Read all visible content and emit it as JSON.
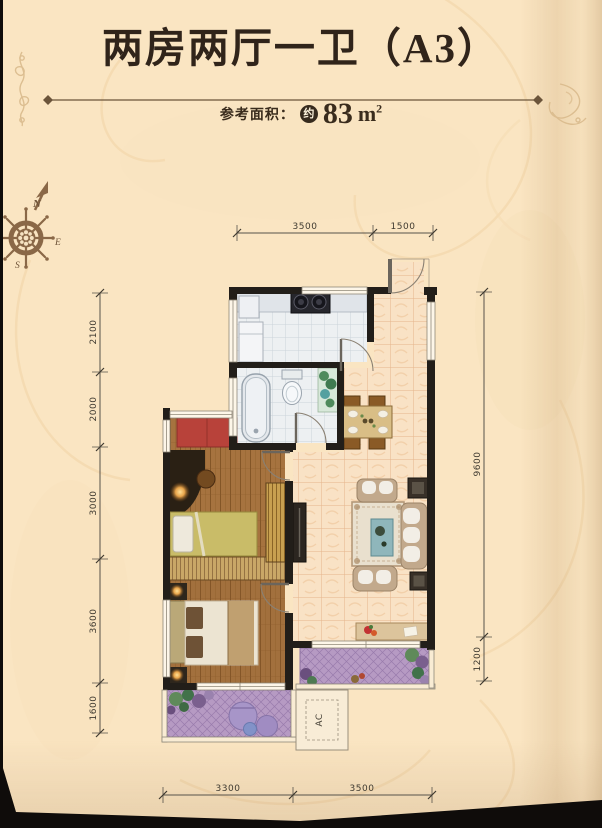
{
  "header": {
    "title": "两房两厅一卫（A3）",
    "area_label": "参考面积：",
    "area_approx_badge": "约",
    "area_value": "83",
    "area_unit": "m",
    "area_exponent": "2"
  },
  "compass": {
    "north": "N",
    "east": "E",
    "south": "S"
  },
  "floor_plan": {
    "ac_label": "AC",
    "dimensions_mm": {
      "top": [
        "3500",
        "1500"
      ],
      "left": [
        "2100",
        "2000",
        "3000",
        "3600",
        "1600"
      ],
      "right": [
        "9600",
        "1200"
      ],
      "bottom": [
        "3300",
        "3500"
      ]
    }
  },
  "colors": {
    "background": "#fae5c2",
    "title_text": "#30241a",
    "wall": "#221e19",
    "dimension_text": "#3f3a30",
    "orange_tile": "#f9e2c5",
    "gray_tile": "#edf0f2",
    "wood_floor": "#a6733f",
    "balcony_tile": "#b69ac3",
    "accent_red": "#b8423a",
    "compass_brown": "#8a6847"
  }
}
